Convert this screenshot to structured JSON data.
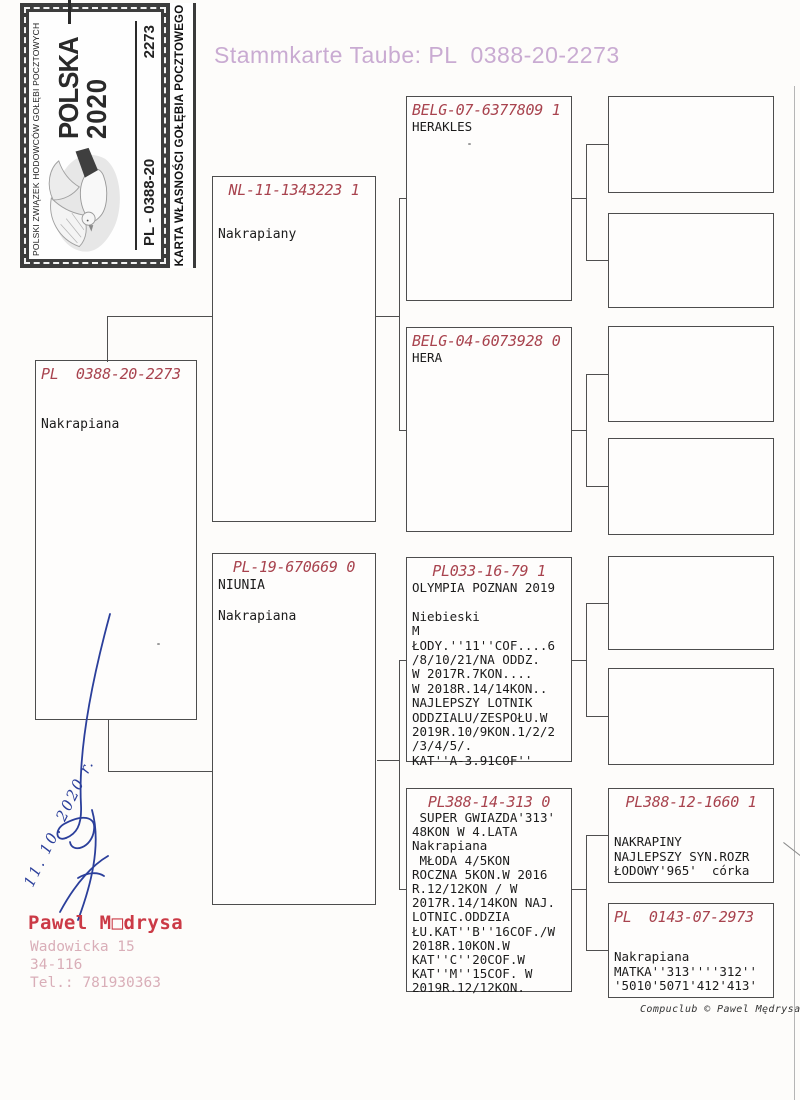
{
  "page": {
    "title": "Stammkarte Taube: PL  0388-20-2273",
    "footer": "Compuclub © Pawel Mędrysa"
  },
  "stamp": {
    "federation": "POLSKI ZWIĄZEK HODOWCÓW GOŁĘBI POCZTOWYCH",
    "country": "POLSKA",
    "year": "2020",
    "ring_series": "PL - 0388-20",
    "ring_number": "2273",
    "card_title": "KARTA WŁASNOŚCI GOŁĘBIA POCZTOWEGO"
  },
  "owner": {
    "name": "Pawel M□drysa",
    "address": [
      "Wadowicka 15",
      "34-116",
      "Tel.: 781930363"
    ],
    "signature_date": "11. 10. 2020 r."
  },
  "pedigree": {
    "subject": {
      "ring": "PL  0388-20-2273",
      "lines": [
        "Nakrapiana"
      ]
    },
    "father": {
      "ring": "NL-11-1343223 1",
      "lines": [
        "Nakrapiany"
      ]
    },
    "mother": {
      "ring": "PL-19-670669 0",
      "lines": [
        "NIUNIA",
        "",
        "Nakrapiana"
      ]
    },
    "grandparents": [
      {
        "ring": "BELG-07-6377809 1",
        "lines": [
          "HERAKLES"
        ]
      },
      {
        "ring": "BELG-04-6073928 0",
        "lines": [
          "HERA"
        ]
      },
      {
        "ring": "PL033-16-79 1",
        "lines": [
          "OLYMPIA POZNAN 2019",
          "",
          "Niebieski",
          "M",
          "ŁODY.''11''COF....6",
          "/8/10/21/NA ODDZ.",
          "W 2017R.7KON....",
          "W 2018R.14/14KON..",
          "NAJLEPSZY LOTNIK",
          "ODDZIALU/ZESPOŁU.W",
          "2019R.10/9KON.1/2/2",
          "/3/4/5/.",
          "KAT''A-3.91COF''"
        ]
      },
      {
        "ring": "PL388-14-313 0",
        "lines": [
          " SUPER GWIAZDA'313'",
          "48KON W 4.LATA",
          "Nakrapiana",
          " MŁODA 4/5KON",
          "ROCZNA 5KON.W 2016",
          "R.12/12KON / W",
          "2017R.14/14KON NAJ.",
          "LOTNIC.ODDZIA",
          "ŁU.KAT''B''16COF./W",
          "2018R.10KON.W",
          "KAT''C''20COF.W",
          "KAT''M''15COF. W",
          "2019R.12/12KON."
        ]
      }
    ],
    "great_grandparents": [
      {},
      {},
      {},
      {},
      {},
      {},
      {
        "ring": "PL388-12-1660 1",
        "lines": [
          "NAKRAPINY",
          "NAJLEPSZY SYN.ROZR",
          "ŁODOWY'965'  córka"
        ]
      },
      {
        "ring": "PL  0143-07-2973",
        "lines": [
          "Nakrapiana",
          "MATKA''313''''312''",
          "'5010'5071'412'413'"
        ]
      }
    ]
  },
  "colors": {
    "ring_red": "#a8434e",
    "title_pink": "#c9abd2",
    "owner_red": "#cb3a46",
    "address_pink": "#d9aeb8",
    "ink_blue": "#2b3f9b"
  }
}
